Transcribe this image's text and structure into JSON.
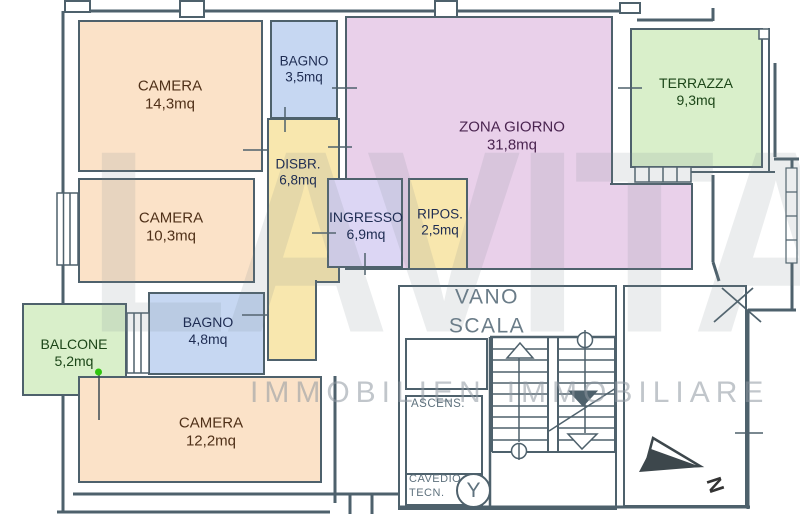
{
  "watermark": {
    "brand": "LAVITA",
    "tagline_left": "IMMOBILIEN",
    "tagline_right": "IMMOBILIARE"
  },
  "rooms": {
    "camera1": {
      "name": "CAMERA",
      "area": "14,3mq"
    },
    "bagno1": {
      "name": "BAGNO",
      "area": "3,5mq"
    },
    "zona_giorno": {
      "name": "ZONA GIORNO",
      "area": "31,8mq"
    },
    "terrazza": {
      "name": "TERRAZZA",
      "area": "9,3mq"
    },
    "disbr": {
      "name": "DISBR.",
      "area": "6,8mq"
    },
    "camera2": {
      "name": "CAMERA",
      "area": "10,3mq"
    },
    "ingresso": {
      "name": "INGRESSO",
      "area": "6,9mq"
    },
    "ripos": {
      "name": "RIPOS.",
      "area": "2,5mq"
    },
    "balcone": {
      "name": "BALCONE",
      "area": "5,2mq"
    },
    "bagno2": {
      "name": "BAGNO",
      "area": "4,8mq"
    },
    "camera3": {
      "name": "CAMERA",
      "area": "12,2mq"
    }
  },
  "stairwell": {
    "label_line1": "VANO",
    "label_line2": "SCALA",
    "elevator": "ASCENS.",
    "shaft_line1": "CAVEDIO",
    "shaft_line2": "TECN.",
    "shaft_symbol": "Y"
  },
  "compass": {
    "label": "N"
  },
  "colors": {
    "wall": "#4e616c",
    "camera_fill": "#fbe2c8",
    "bagno_fill": "#c6d7f2",
    "zona_giorno_fill": "#e9d0ea",
    "terrazza_balcone_fill": "#d9efca",
    "corridor_fill": "#f8e7ae",
    "ingresso_fill": "#dcd6f4",
    "marker_green": "#2fc40e",
    "watermark_gray": "#8e98a0"
  }
}
